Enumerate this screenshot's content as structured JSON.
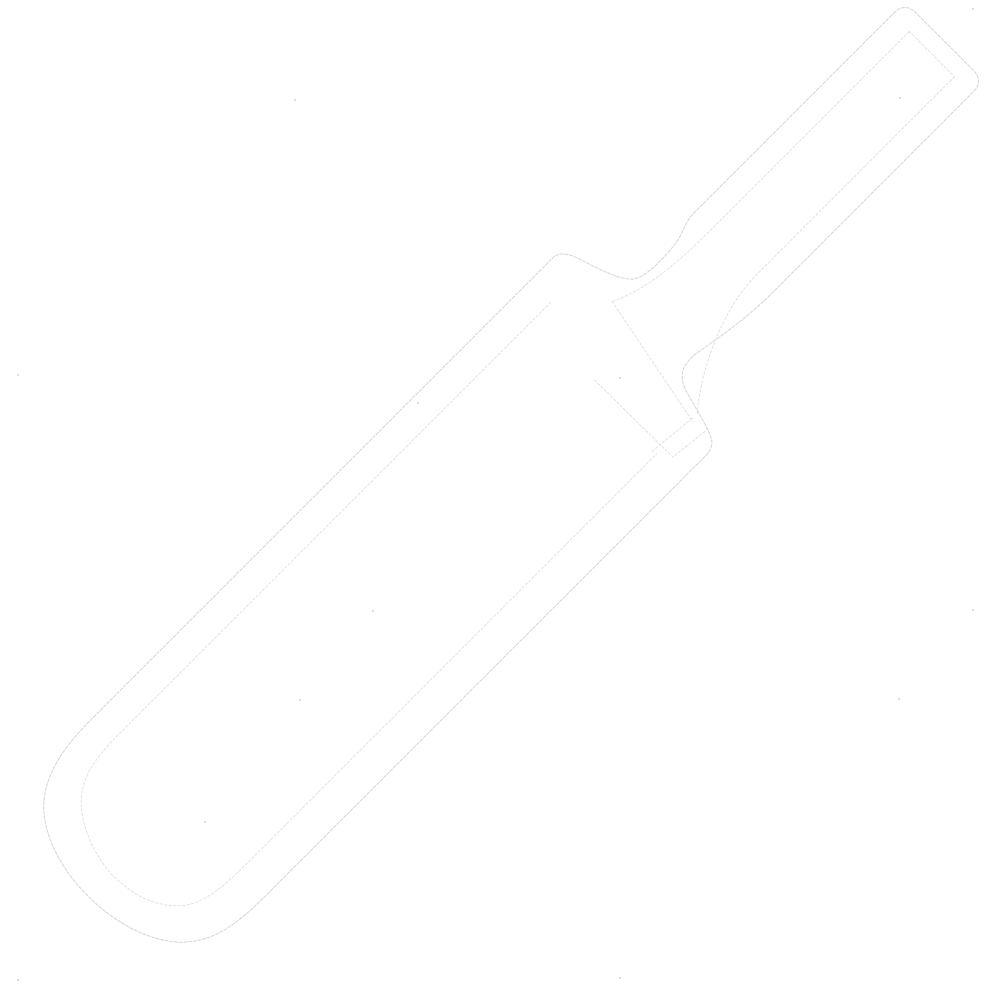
{
  "page": {
    "background_color": "#ffffff",
    "content_type": "line-art illustration",
    "description": "Very faint light-gray outline drawing of a cricket bat on a plain white background, tilted about 45 degrees with the handle at the upper right and the blade extending down to the lower left"
  },
  "illustration": {
    "object": "Cricket bat",
    "style": "thin broken dotted light-gray contour lines, double outline",
    "orientation": "diagonal; handle upper-right, rounded toe lower-left",
    "outer_line_color": "#d4d4d4",
    "inner_line_color": "#dedede",
    "speck_color": "#b3b3b3",
    "background_color": "#ffffff",
    "parts": [
      {
        "name": "handle",
        "label": "Handle with rounded top and inner outline"
      },
      {
        "name": "shoulders",
        "label": "Concave shoulders tapering from handle to blade"
      },
      {
        "name": "splice",
        "label": "Splice/collar detail lines where handle meets blade face"
      },
      {
        "name": "blade",
        "label": "Long flat blade with parallel inner outline"
      },
      {
        "name": "toe",
        "label": "Rounded toe at the bottom of the blade"
      }
    ],
    "artifact_specks": [
      [
        295,
        100
      ],
      [
        973,
        9
      ],
      [
        900,
        98
      ],
      [
        18,
        375
      ],
      [
        418,
        403
      ],
      [
        620,
        378
      ],
      [
        373,
        611
      ],
      [
        300,
        700
      ],
      [
        973,
        610
      ],
      [
        899,
        699
      ],
      [
        205,
        822
      ],
      [
        620,
        978
      ],
      [
        18,
        980
      ]
    ]
  }
}
